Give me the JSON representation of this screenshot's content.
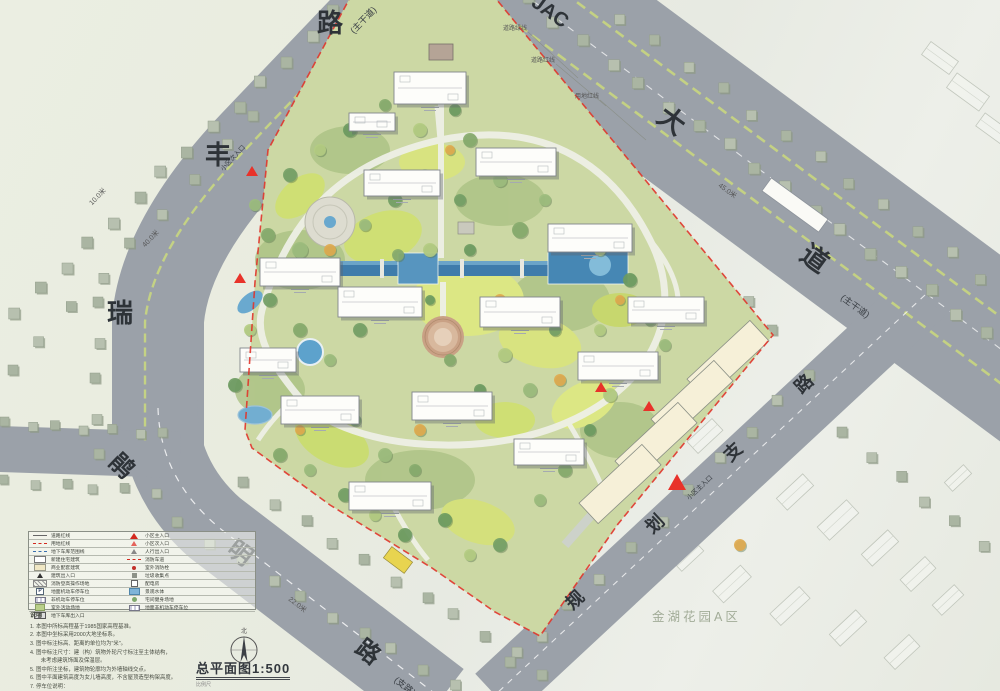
{
  "roads": {
    "northwest": {
      "name_chars": [
        "瑞",
        "丰",
        "路"
      ],
      "type_label": "(主干道)",
      "dim_labels": [
        "10.0米",
        "40.0米"
      ]
    },
    "northeast": {
      "name_chars": [
        "JAC",
        "大",
        "道"
      ],
      "type_label": "(主干道)",
      "dim_label": "45.0米"
    },
    "east": {
      "name_chars": [
        "规",
        "划",
        "支",
        "路"
      ]
    },
    "south": {
      "name_chars": [
        "鹃",
        "明",
        "路"
      ],
      "type_label": "(支路)",
      "dim_label": "22.0米"
    }
  },
  "callouts": {
    "items": [
      "道路绿线",
      "道路红线",
      "用地红线"
    ]
  },
  "entrances": {
    "secondary_label": "小区次入口",
    "main_label": "小区主入口"
  },
  "neighborhood": {
    "label": "金湖花园A区"
  },
  "title_block": {
    "title": "总平面图1:500",
    "scale_caption": "比例尺",
    "north_label": "北"
  },
  "legend": {
    "left": [
      "道路红线",
      "用地红线",
      "地下车库范围线",
      "新建住宅建筑",
      "商业配套建筑",
      "建筑出入口",
      "消防登高操作场地",
      "地面机动车停车位",
      "非机动车停车位",
      "室外活动场地",
      "地下车库出入口"
    ],
    "right": [
      "小区主入口",
      "小区次入口",
      "人行出入口",
      "消防车道",
      "室外消防栓",
      "垃圾收集点",
      "配电房",
      "景观水体",
      "宅间健身场地",
      "地面非机动车停车位"
    ]
  },
  "notes": {
    "heading": "说明",
    "lines": [
      "1. 本图中所标高程基于1985国家高程基准。",
      "2. 本图中坐标采用2000大地坐标系。",
      "3. 图中标注标高、距离的单位均为\"米\"。",
      "4. 图中标注尺寸：建（构）筑物外轮尺寸标注至主体结构，",
      "　　未考虑建筑饰面及保温层。",
      "5. 图中所注坐标，建筑物轮廓均为外墙轴线交点。",
      "6. 图中平面建筑高度为女儿墙高度，不含屋顶造型构架高度。",
      "7. 停车位说明：",
      "(1) 地块内机动车停车位共计xxx辆，其中地下车库停车位xxx辆。"
    ]
  }
}
